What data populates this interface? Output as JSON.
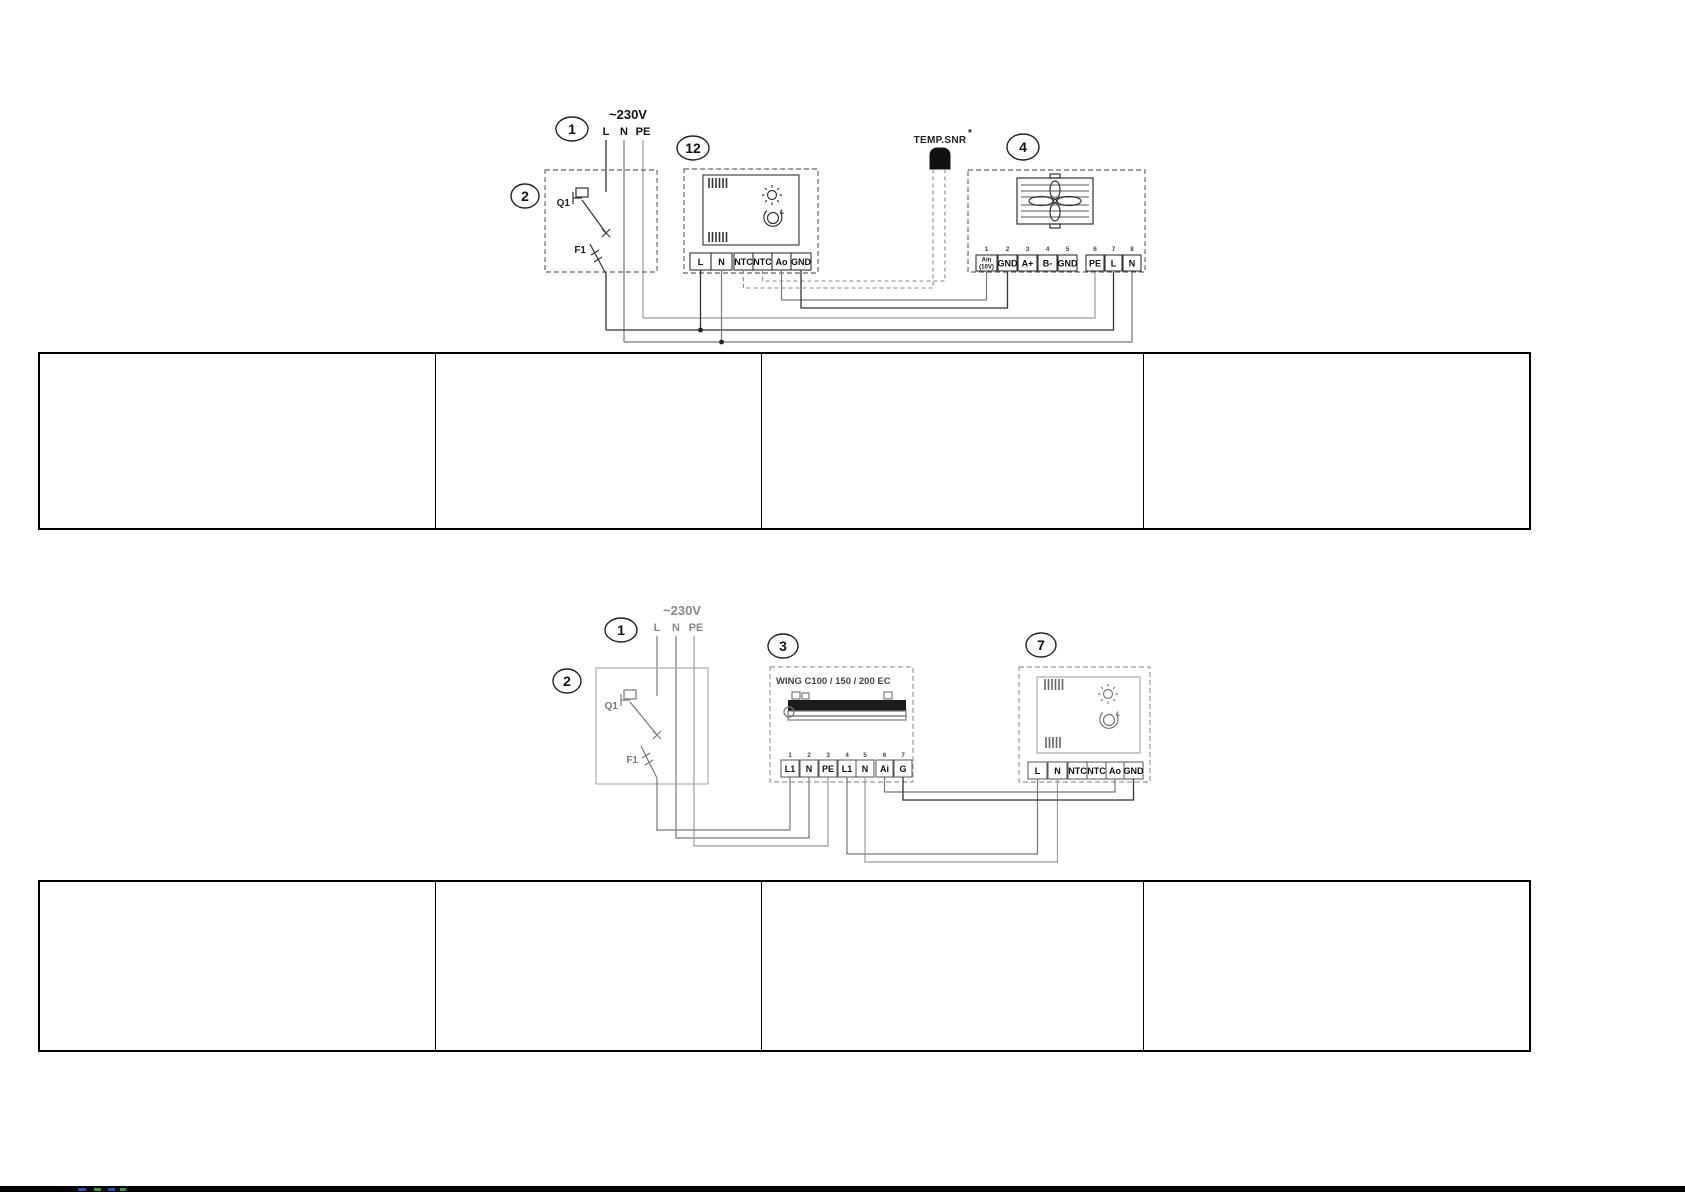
{
  "top_diagram": {
    "supply": {
      "voltage": "~230V",
      "lines": [
        "L",
        "N",
        "PE"
      ]
    },
    "callouts": {
      "c1": "1",
      "c2": "2",
      "c12": "12",
      "c4": "4"
    },
    "breaker": {
      "label": "Q1"
    },
    "fuse": {
      "label": "F1"
    },
    "controller": {
      "terminals": [
        "L",
        "N",
        "NTC",
        "NTC",
        "Ao",
        "GND"
      ]
    },
    "sensor": {
      "label": "TEMP.SNR",
      "asterisk": "*"
    },
    "fan_unit": {
      "terminal_numbers": [
        "1",
        "2",
        "3",
        "4",
        "5",
        "6",
        "7",
        "8"
      ],
      "terminals": [
        "Ain",
        "GND",
        "A+",
        "B-",
        "GND",
        "PE",
        "L",
        "N"
      ],
      "ain_sub": "(10V)"
    }
  },
  "bottom_diagram": {
    "supply": {
      "voltage": "~230V",
      "lines": [
        "L",
        "N",
        "PE"
      ]
    },
    "callouts": {
      "c1": "1",
      "c2": "2",
      "c3": "3",
      "c7": "7"
    },
    "breaker": {
      "label": "Q1"
    },
    "fuse": {
      "label": "F1"
    },
    "air_curtain": {
      "title": "WING C100 / 150 / 200 EC",
      "terminal_numbers": [
        "1",
        "2",
        "3",
        "4",
        "5",
        "6",
        "7"
      ],
      "terminals": [
        "L1",
        "N",
        "PE",
        "L1",
        "N",
        "Ai",
        "G"
      ]
    },
    "controller": {
      "terminals": [
        "L",
        "N",
        "NTC",
        "NTC",
        "Ao",
        "GND"
      ]
    }
  },
  "colors": {
    "wire_dark": "#333333",
    "wire_gray": "#8a8a8a",
    "table_border": "#000000",
    "sensor_body": "#111111"
  }
}
